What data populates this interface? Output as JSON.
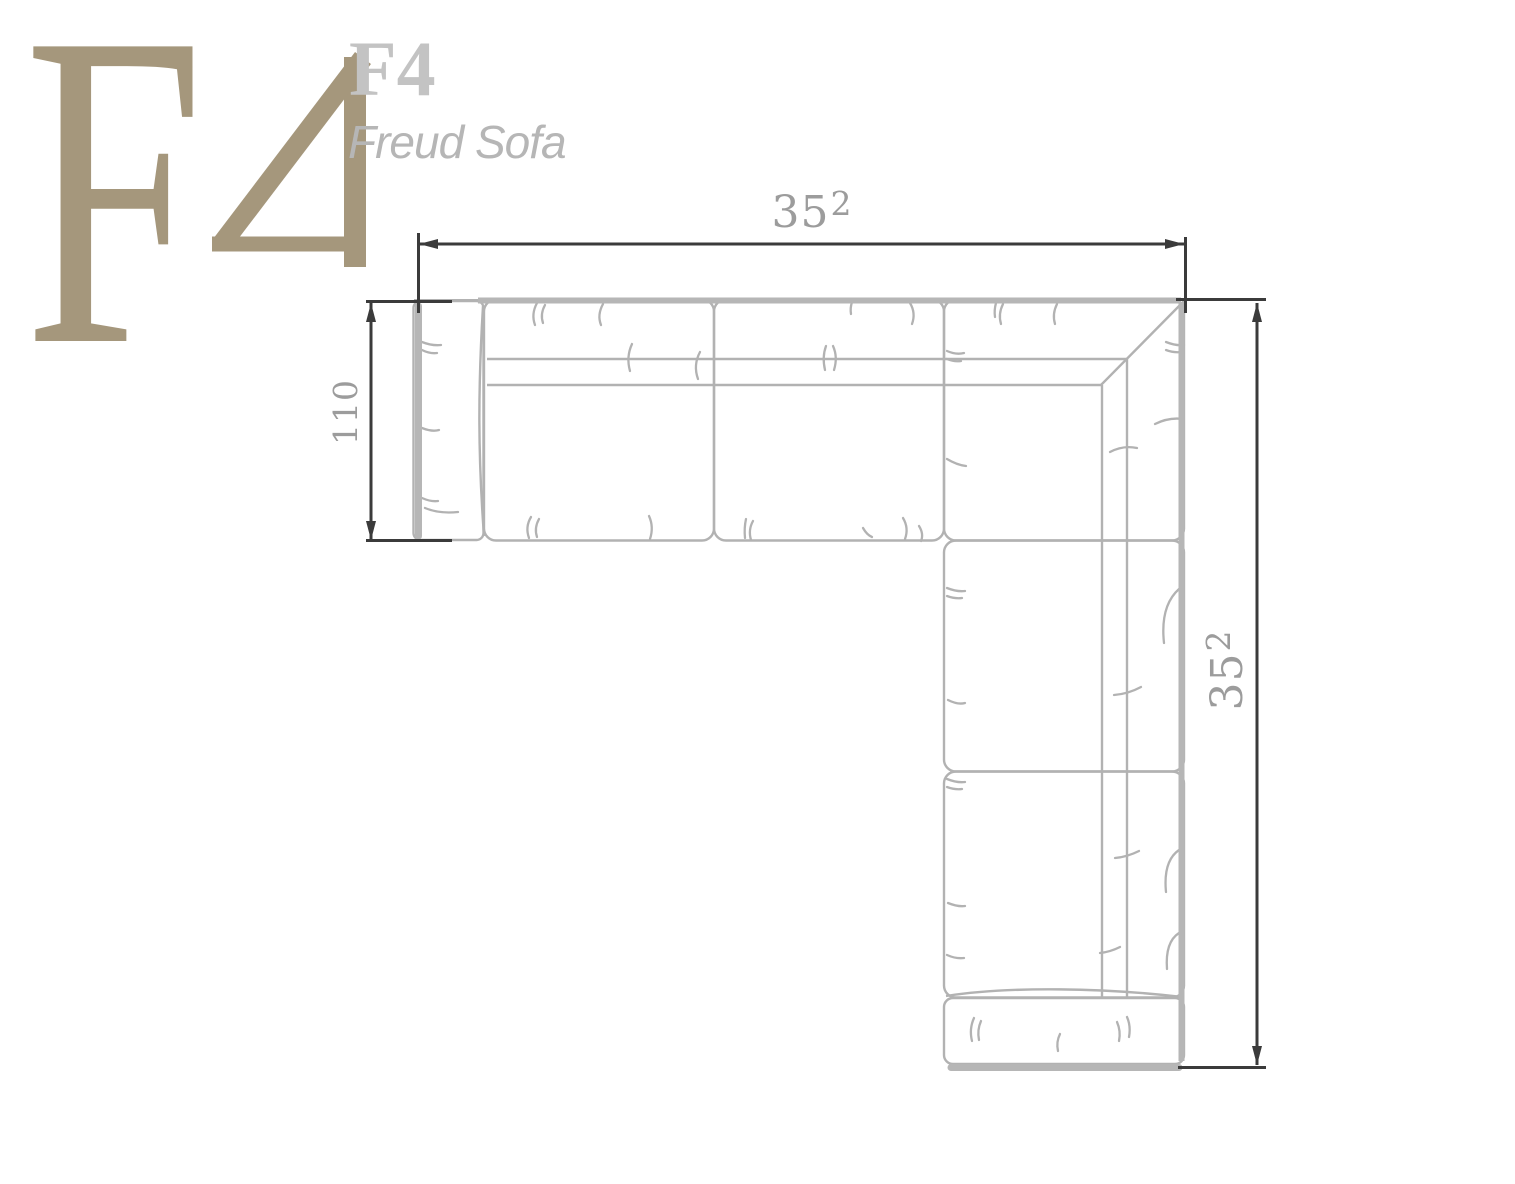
{
  "logo": {
    "monogram_letter": "F",
    "monogram_digit": "4",
    "model_code": "F4",
    "product_name": "Freud Sofa"
  },
  "dimensions": {
    "width": {
      "value": "352",
      "main": "35",
      "sup": "2"
    },
    "depth": {
      "value": "110"
    },
    "height": {
      "value": "352",
      "main": "35",
      "sup": "2"
    }
  },
  "colors": {
    "accent_tan": "#a5977c",
    "logo_gray": "#c3c3c3",
    "subtitle_gray": "#b6b6b6",
    "drawing_line": "#b2b2b2",
    "drawing_line_heavy": "#b6b6b6",
    "dimension_line": "#3b3b3b",
    "dimension_text": "#9c9c9c",
    "background": "#ffffff"
  }
}
